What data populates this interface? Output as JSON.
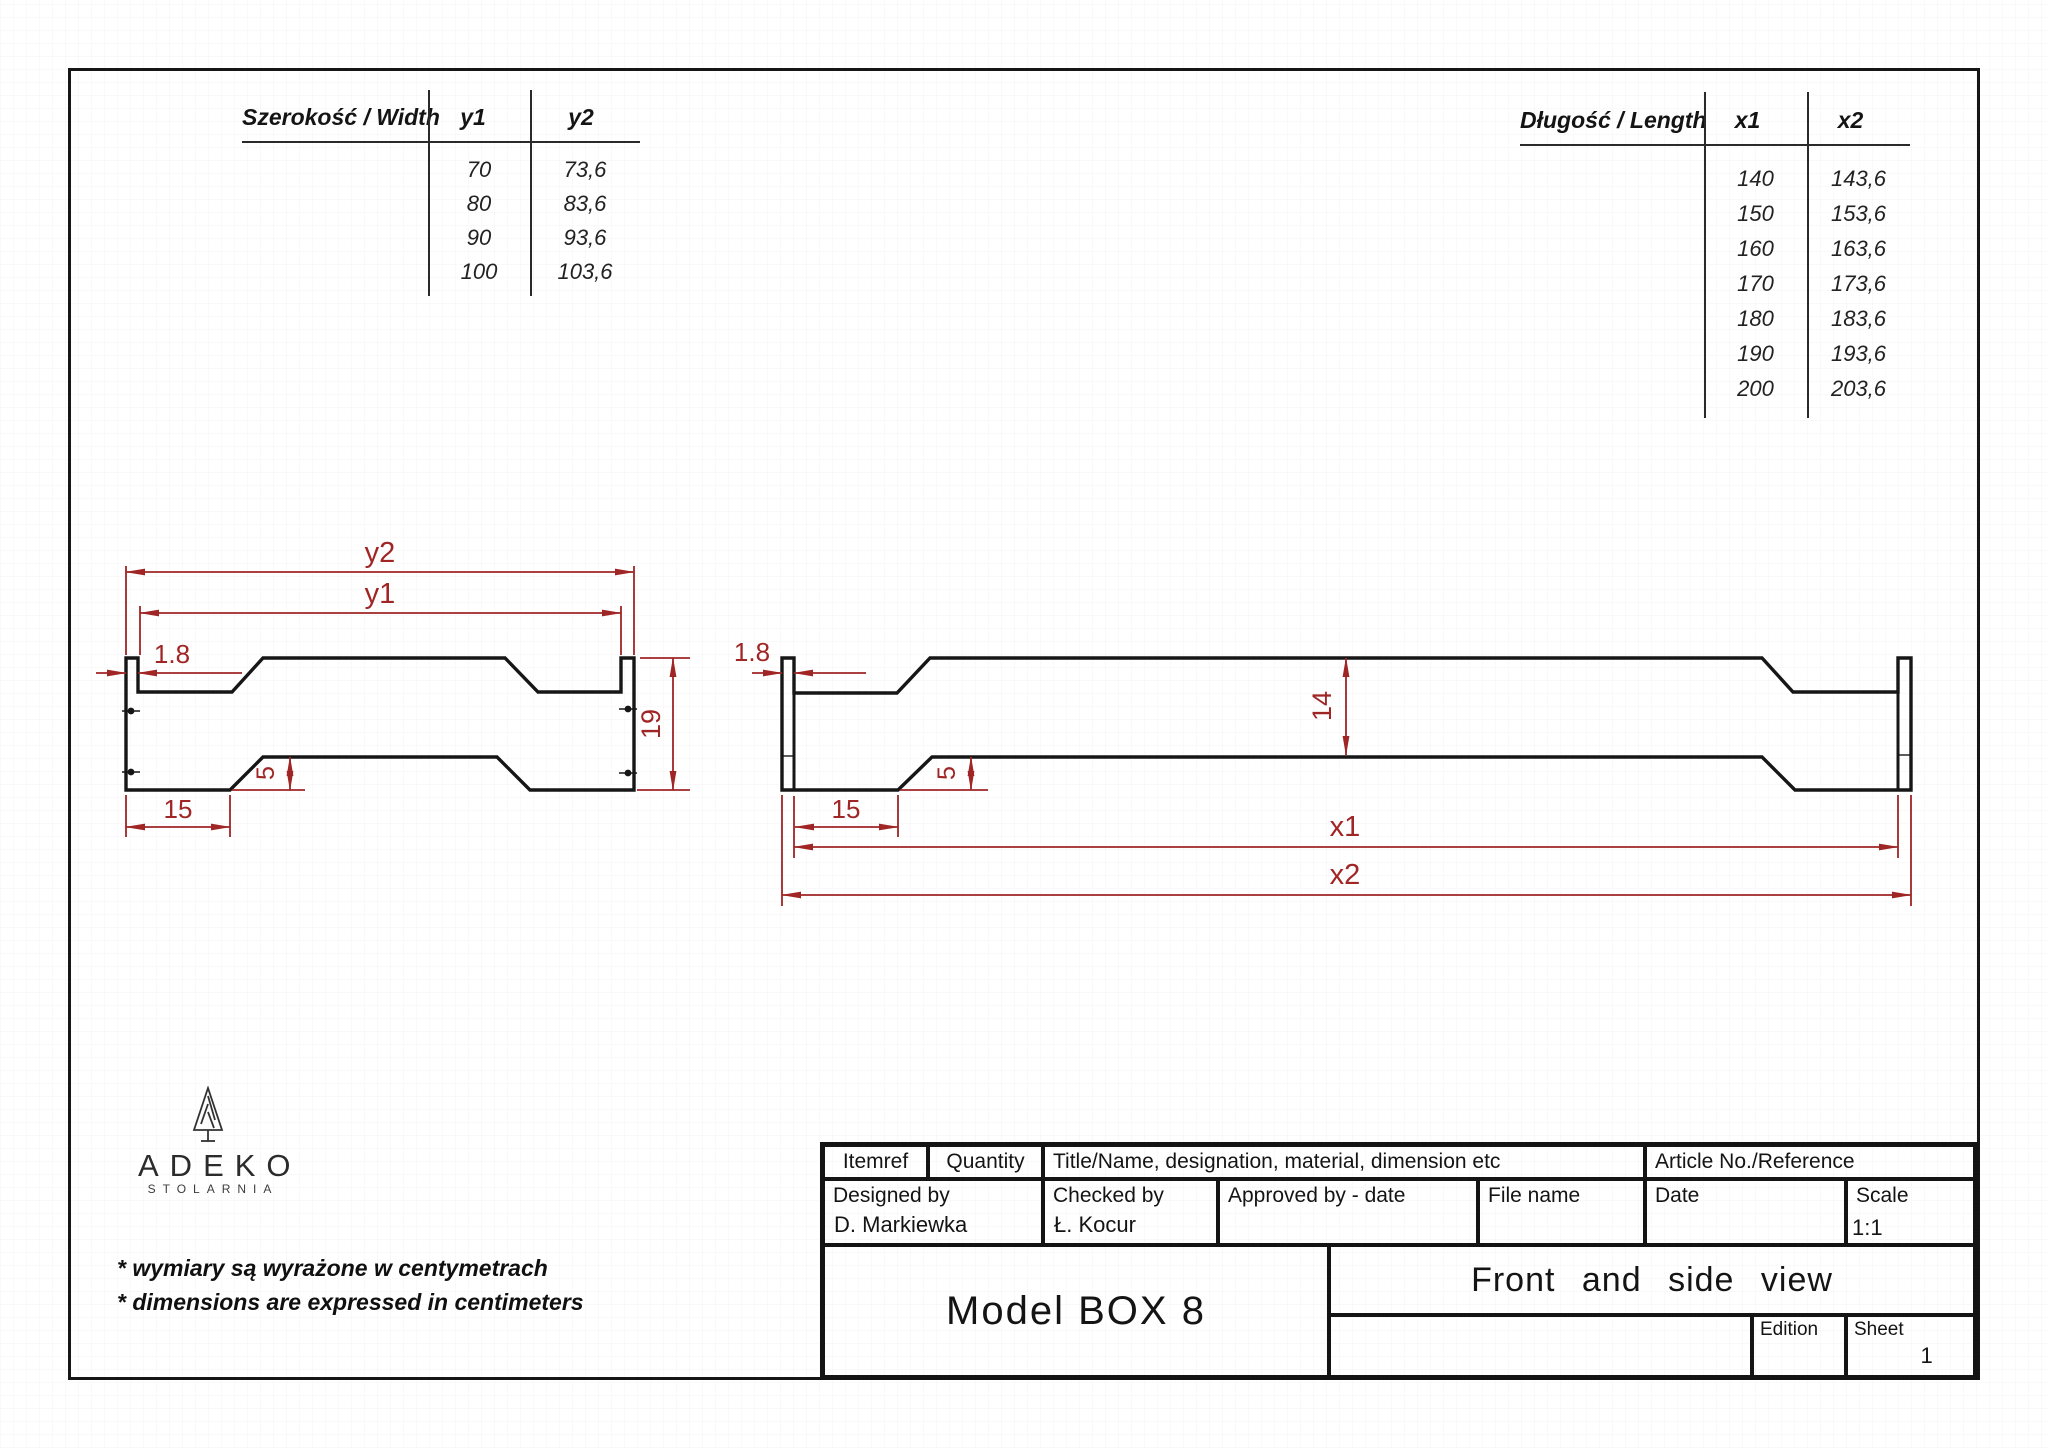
{
  "width_table": {
    "header": "Szerokość / Width",
    "col1": "y1",
    "col2": "y2",
    "rows": [
      [
        "70",
        "73,6"
      ],
      [
        "80",
        "83,6"
      ],
      [
        "90",
        "93,6"
      ],
      [
        "100",
        "103,6"
      ]
    ]
  },
  "length_table": {
    "header": "Długość / Length",
    "col1": "x1",
    "col2": "x2",
    "rows": [
      [
        "140",
        "143,6"
      ],
      [
        "150",
        "153,6"
      ],
      [
        "160",
        "163,6"
      ],
      [
        "170",
        "173,6"
      ],
      [
        "180",
        "183,6"
      ],
      [
        "190",
        "193,6"
      ],
      [
        "200",
        "203,6"
      ]
    ]
  },
  "front_view": {
    "dim_y2": "y2",
    "dim_y1": "y1",
    "dim_tab": "1.8",
    "dim_height": "19",
    "dim_notch": "5",
    "dim_foot": "15"
  },
  "side_view": {
    "dim_tab": "1.8",
    "dim_height": "14",
    "dim_notch": "5",
    "dim_foot": "15",
    "dim_x1": "x1",
    "dim_x2": "x2"
  },
  "logo": {
    "name": "ADEKO",
    "subtitle": "STOLARNIA"
  },
  "notes": {
    "pl": "* wymiary są wyrażone w centymetrach",
    "en": "* dimensions are expressed in centimeters"
  },
  "title_block": {
    "itemref": "Itemref",
    "quantity": "Quantity",
    "title_name": "Title/Name, designation, material, dimension etc",
    "article": "Article No./Reference",
    "designed_by": "Designed by",
    "designed_by_value": "D. Markiewka",
    "checked_by": "Checked by",
    "checked_by_value": "Ł. Kocur",
    "approved_by": "Approved by - date",
    "file_name": "File name",
    "date": "Date",
    "scale": "Scale",
    "scale_value": "1:1",
    "model": "Model BOX 8",
    "view_title": "Front and side view",
    "edition": "Edition",
    "sheet": "Sheet",
    "sheet_value": "1"
  }
}
